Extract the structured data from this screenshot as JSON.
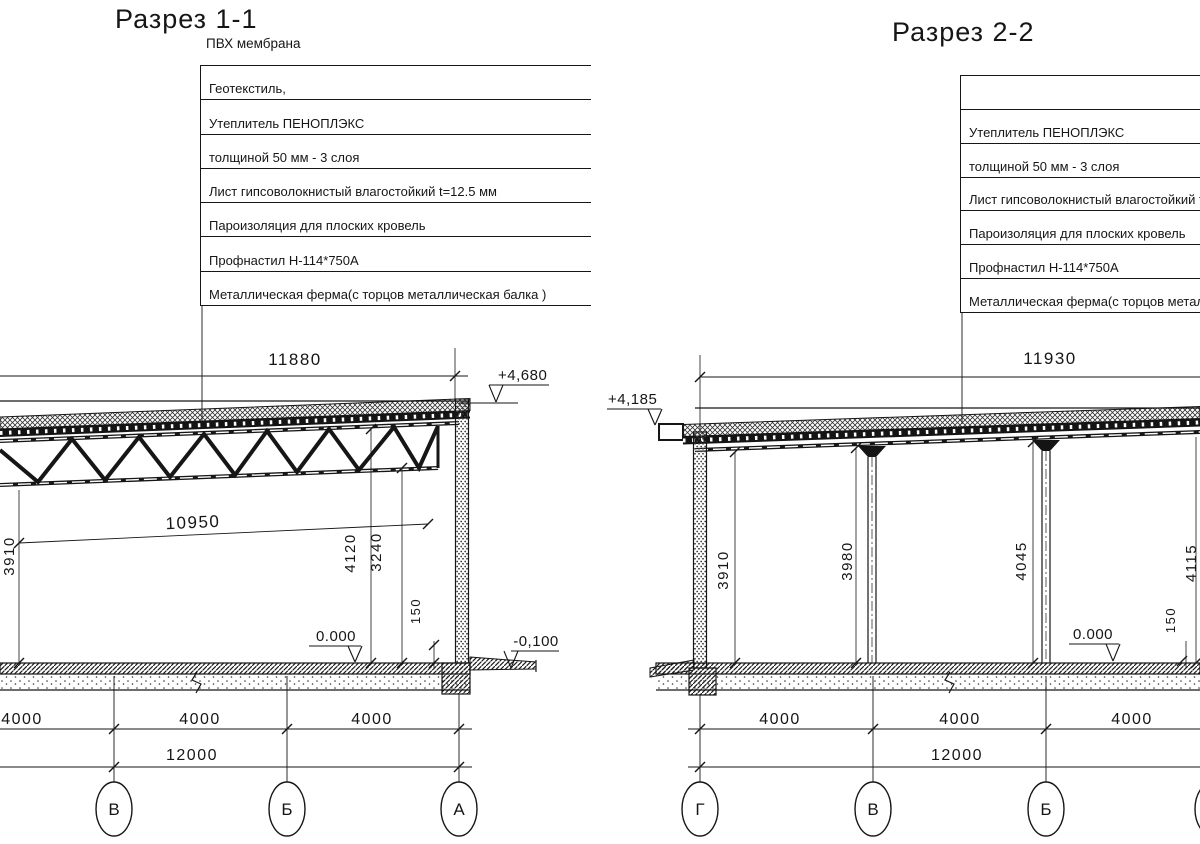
{
  "drawing": {
    "sections": [
      {
        "title": "Разрез 1-1",
        "callout_note": "ПВХ мембрана",
        "callout_rows": [
          "Геотекстиль,",
          "Утеплитель ПЕНОПЛЭКС",
          "толщиной 50 мм - 3 слоя",
          "Лист гипсоволокнистый влагостойкий t=12.5 мм",
          "Пароизоляция для плоских кровель",
          "Профнастил Н-114*750А",
          "Металлическая ферма(с торцов металлическая балка )"
        ],
        "dims": {
          "span_top": "11880",
          "roof_elevation": "+4,680",
          "span_inner": "10950",
          "height_left": "3910",
          "height_truss_top": "4120",
          "height_truss_bottom": "3240",
          "plinth": "150",
          "floor_elevation": "0.000",
          "ground_elevation": "-0,100",
          "bays": [
            "4000",
            "4000",
            "4000"
          ],
          "total": "12000"
        },
        "axes": [
          "В",
          "Б",
          "А"
        ]
      },
      {
        "title": "Разрез 2-2",
        "callout_rows": [
          "",
          "Утеплитель ПЕНОПЛЭКС",
          "толщиной 50 мм - 3 слоя",
          "Лист гипсоволокнистый влагостойкий t=12.5 мм",
          "Пароизоляция для плоских кровель",
          "Профнастил Н-114*750А",
          "Металлическая ферма(с торцов металлическая балка )"
        ],
        "dims": {
          "span_top": "11930",
          "roof_elevation": "+4,185",
          "heights": [
            "3910",
            "3980",
            "4045",
            "4115"
          ],
          "plinth": "150",
          "floor_elevation": "0.000",
          "bays": [
            "4000",
            "4000",
            "4000"
          ],
          "total": "12000"
        },
        "axes": [
          "Г",
          "В",
          "Б"
        ]
      }
    ]
  }
}
